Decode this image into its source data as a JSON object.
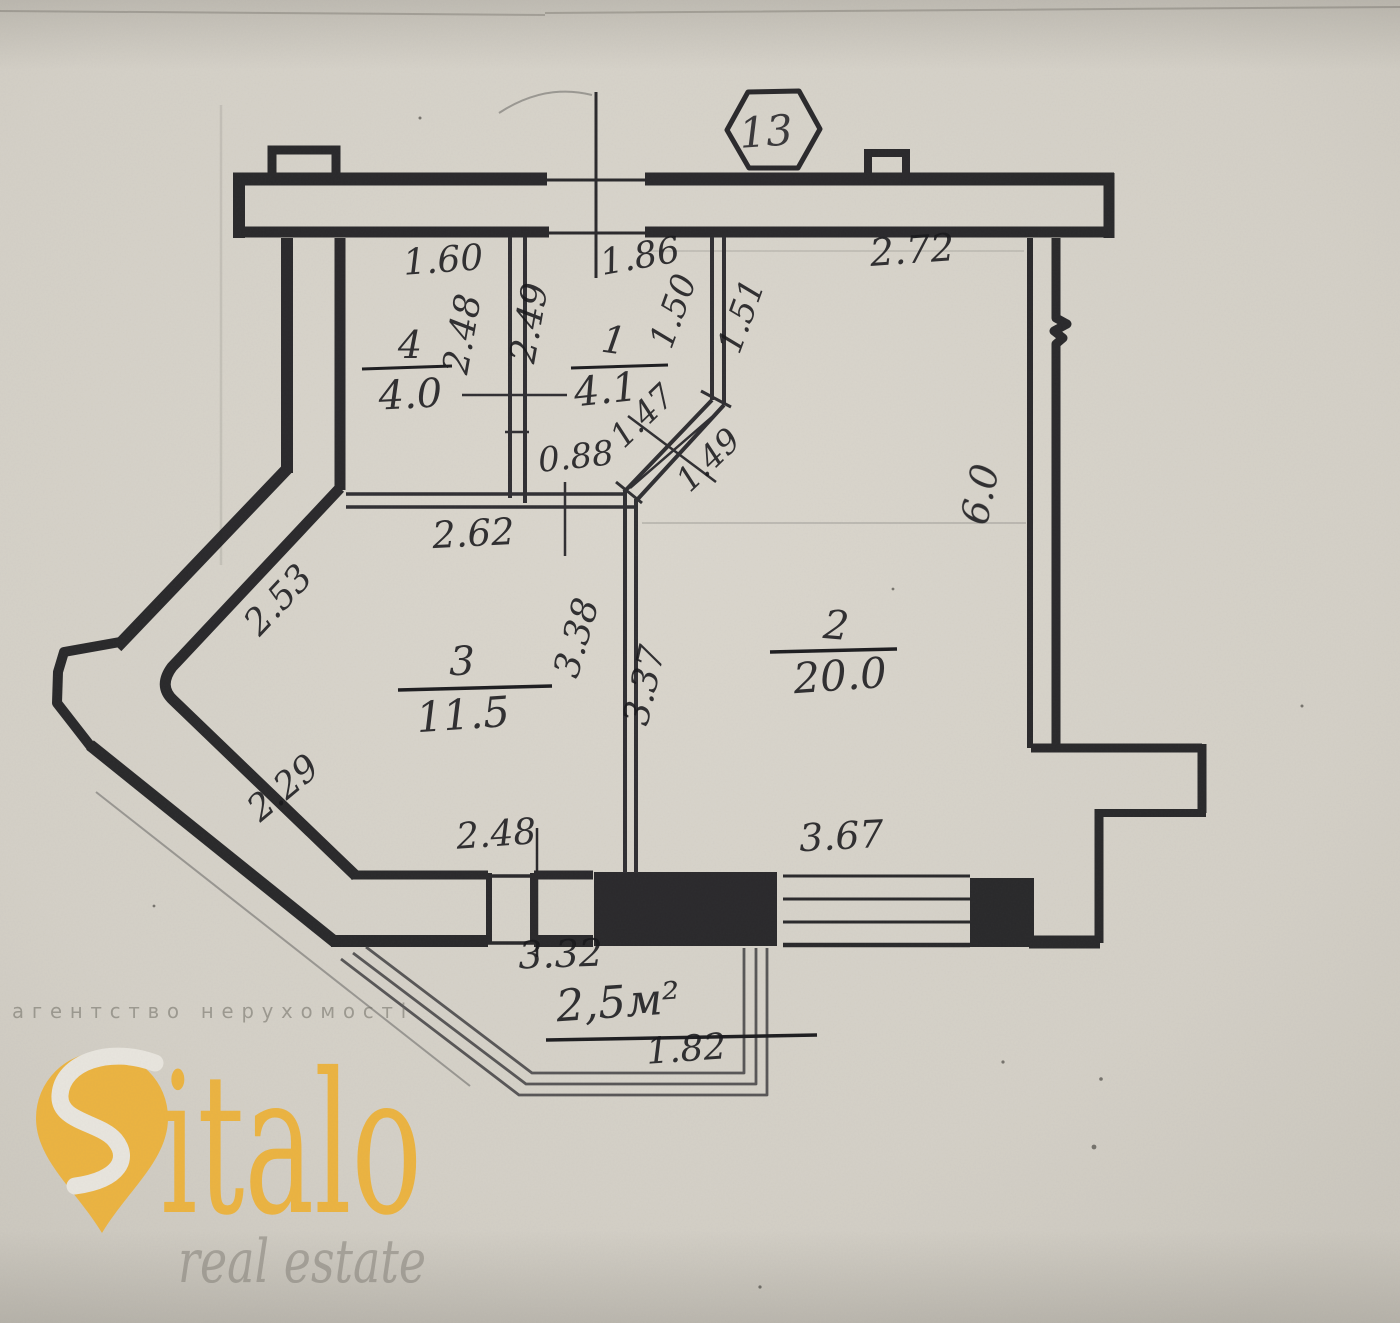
{
  "badge": {
    "number": "13"
  },
  "rooms": {
    "r1": {
      "number": "1",
      "area": "4.1"
    },
    "r2": {
      "number": "2",
      "area": "20.0"
    },
    "r3": {
      "number": "3",
      "area": "11.5"
    },
    "r4": {
      "number": "4",
      "area": "4.0"
    }
  },
  "balcony": {
    "area": "2,5м²",
    "width": "1.82"
  },
  "dims": {
    "top_left": "1.60",
    "entry": "1.86",
    "top_right": "2.72",
    "r4_height": "2.48",
    "r1_height": "2.49",
    "hall_seg1": "1.50",
    "hall_seg2": "1.51",
    "niche": "0.88",
    "diag1": "1.47",
    "diag2": "1.49",
    "right_wall": "6.0",
    "r3_top": "2.62",
    "diag_upper": "2.53",
    "r3_right": "3.38",
    "r2_left": "3.37",
    "diag_lower": "2.29",
    "balcony_door": "2.48",
    "r2_bottom": "3.67",
    "r3_bottom": "3.32"
  },
  "watermark": {
    "agency_line": "агентство нерухомості",
    "brand": "italo",
    "brand_sub": "real estate"
  },
  "colors": {
    "paper": "#d6d2c9",
    "ink": "#1d1d20",
    "brand_yellow": "#ecb441",
    "watermark_gray": "#8f8c83"
  }
}
